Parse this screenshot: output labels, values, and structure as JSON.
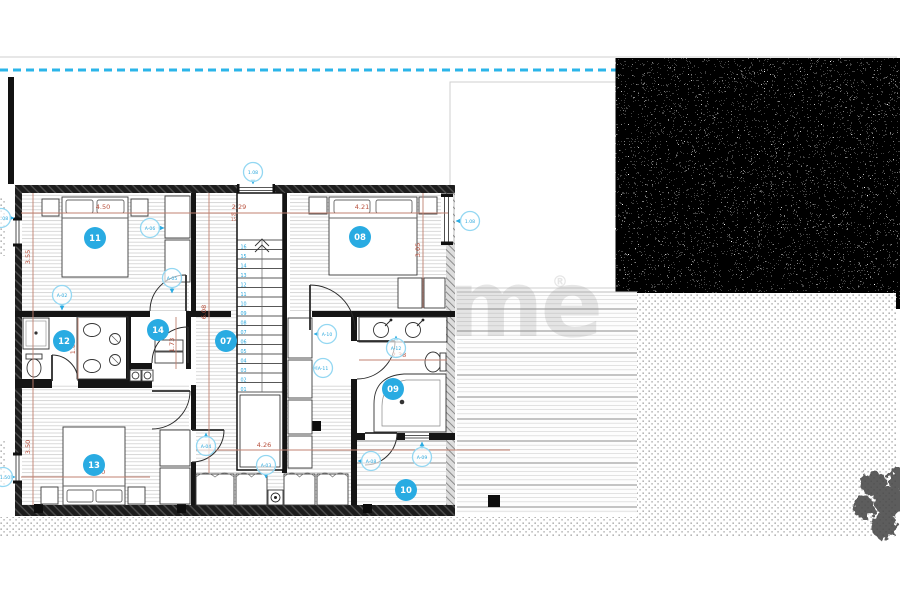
{
  "watermark": {
    "brand": "zome",
    "reg": "®"
  },
  "rooms": {
    "r07": "07",
    "r08": "08",
    "r09": "09",
    "r10": "10",
    "r11": "11",
    "r12": "12",
    "r13": "13",
    "r14": "14"
  },
  "dims": {
    "top_450": "4.50",
    "top_229": "2.29",
    "top_421": "4.21",
    "left_355": "3.55",
    "left_350": "3.50",
    "hall_608": "6.08",
    "right_305": "3.05",
    "bath_238": "2.38",
    "hall_426": "4.26",
    "r13_450": "4.50",
    "bath_180": "1.80",
    "r14_173": "1.73",
    "sill_90": "90",
    "sill_15": "15"
  },
  "tags": {
    "t1": "1.08",
    "t2": "1.08",
    "t3": "1.08",
    "t4": "A-06",
    "t5": "A-02",
    "t6": "A-05",
    "t7": "A-10",
    "t8": "A-11",
    "t9": "A-12",
    "t10": "A-04",
    "t11": "A-03",
    "t12": "A-09",
    "t13": "1.50",
    "t14": "A-08"
  },
  "stairs": {
    "steps": [
      "01",
      "02",
      "03",
      "04",
      "05",
      "06",
      "07",
      "08",
      "09",
      "10",
      "11",
      "12",
      "13",
      "14",
      "15",
      "16"
    ]
  },
  "colors": {
    "accent": "#29abe2",
    "dimension": "#b8503c",
    "tag_stroke": "#93d7f2"
  }
}
